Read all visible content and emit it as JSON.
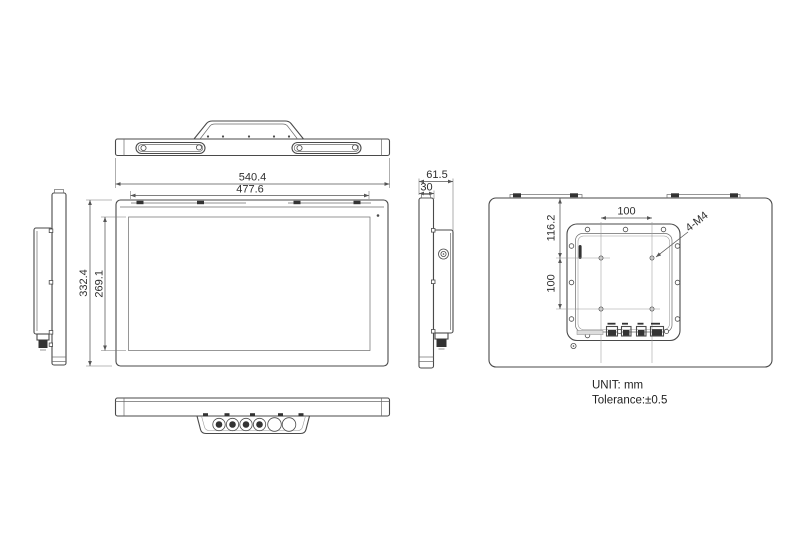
{
  "drawing": {
    "notes": {
      "unit": "UNIT: mm",
      "tolerance": "Tolerance:±0.5"
    },
    "dimensions": {
      "overall_width": "540.4",
      "display_width": "477.6",
      "overall_height": "332.4",
      "display_height": "269.1",
      "overall_depth": "61.5",
      "panel_depth": "30",
      "vesa_top_offset": "116.2",
      "vesa_spacing_horizontal": "100",
      "vesa_spacing_vertical": "100",
      "vesa_thread_callout": "4-M4"
    },
    "colors": {
      "line": "#4a4a4a",
      "dimension_line": "#555555",
      "centerline": "#999999",
      "dark_fill": "#333333",
      "background": "#ffffff"
    }
  }
}
